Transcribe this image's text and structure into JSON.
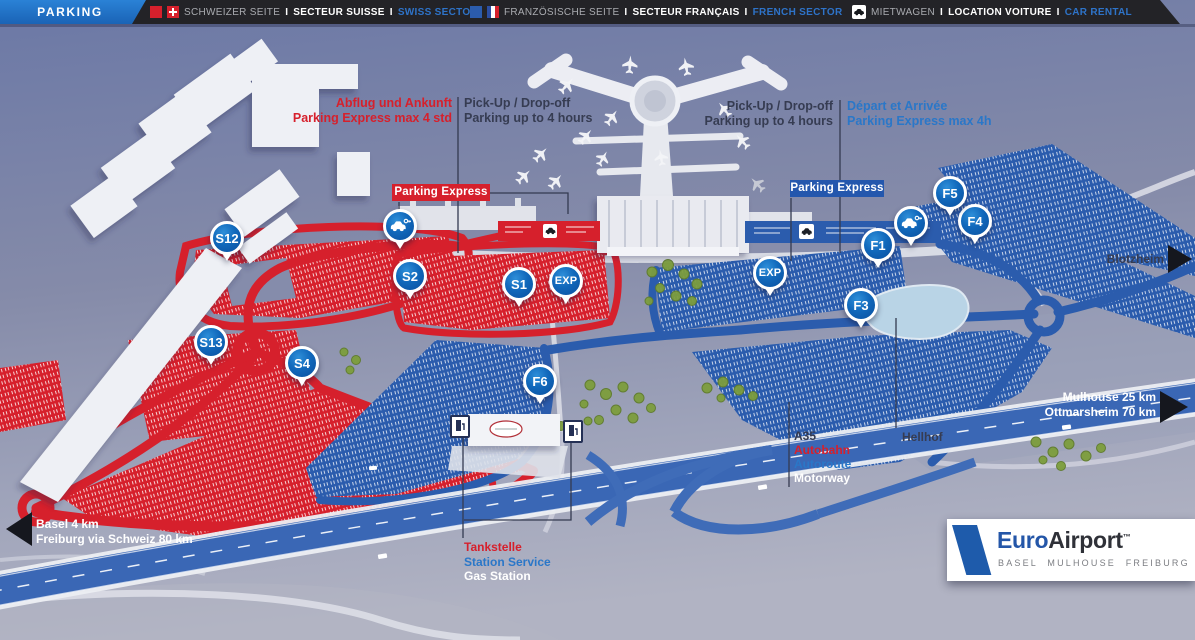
{
  "header": {
    "title": "PARKING",
    "separator": "I",
    "swiss": {
      "de": "SCHWEIZER SEITE",
      "fr": "SECTEUR SUISSE",
      "en": "SWISS SECTOR"
    },
    "french": {
      "de": "FRANZÖSISCHE SEITE",
      "fr": "SECTEUR FRANÇAIS",
      "en": "FRENCH SECTOR"
    },
    "rental": {
      "de": "MIETWAGEN",
      "fr": "LOCATION VOITURE",
      "en": "CAR RENTAL"
    }
  },
  "annotations": {
    "swiss_express": {
      "line1": "Abflug und Ankunft",
      "line2": "Parking Express max 4 std"
    },
    "pickup_left": {
      "line1": "Pick-Up / Drop-off",
      "line2": "Parking up to 4 hours"
    },
    "pickup_right": {
      "line1": "Pick-Up / Drop-off",
      "line2": "Parking up to 4 hours"
    },
    "french_express": {
      "line1": "Départ et Arrivée",
      "line2": "Parking Express max 4h"
    },
    "express_box_swiss": "Parking Express",
    "express_box_french": "Parking Express",
    "a35": {
      "line1": "A35",
      "line2": "Autobahn",
      "line3": "Autoroute",
      "line4": "Motorway"
    },
    "hellhof": "Hellhof",
    "gas_station": {
      "de": "Tankstelle",
      "fr": "Station Service",
      "en": "Gas Station"
    }
  },
  "directions": {
    "basel": {
      "line1": "Basel 4 km",
      "line2": "Freiburg via Schweiz 80 km"
    },
    "mulhouse": {
      "line1": "Mulhouse 25 km",
      "line2": "Ottmarsheim 70 km"
    },
    "blotzheim": "Blotzheim"
  },
  "markers": {
    "s12": "S12",
    "s13": "S13",
    "s4": "S4",
    "s2": "S2",
    "s1": "S1",
    "exp_swiss": "EXP",
    "f6": "F6",
    "exp_french": "EXP",
    "f1": "F1",
    "f3": "F3",
    "f4": "F4",
    "f5": "F5"
  },
  "logo": {
    "brand_primary": "Euro",
    "brand_secondary": "Airport",
    "trademark": "™",
    "subtitle": "BASEL MULHOUSE FREIBURG"
  },
  "colors": {
    "swiss_red": "#d6202c",
    "french_blue": "#2b5cad",
    "marker_blue": "#0a57a8",
    "header_blue": "#1a6dc0",
    "accent_text_blue": "#2a77c8",
    "dark_label": "#363c52"
  }
}
